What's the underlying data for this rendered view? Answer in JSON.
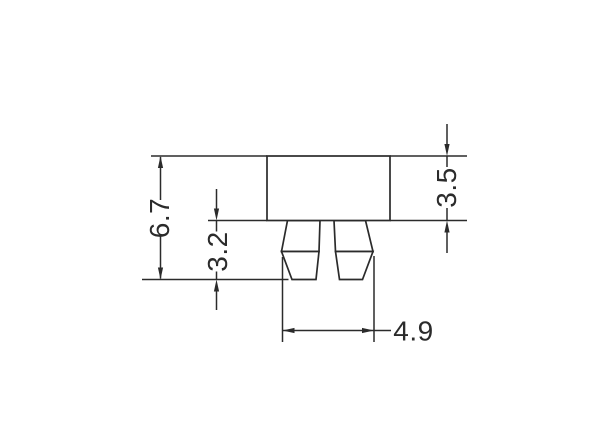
{
  "drawing": {
    "kind": "technical-dimension-drawing",
    "part": "component body with two tapered pins",
    "dimensions": {
      "overall_height": "6.7",
      "pin_length": "3.2",
      "body_height": "3.5",
      "pin_span": "4.9"
    },
    "colors": {
      "line": "#2b2b2b",
      "background": "#ffffff"
    }
  }
}
